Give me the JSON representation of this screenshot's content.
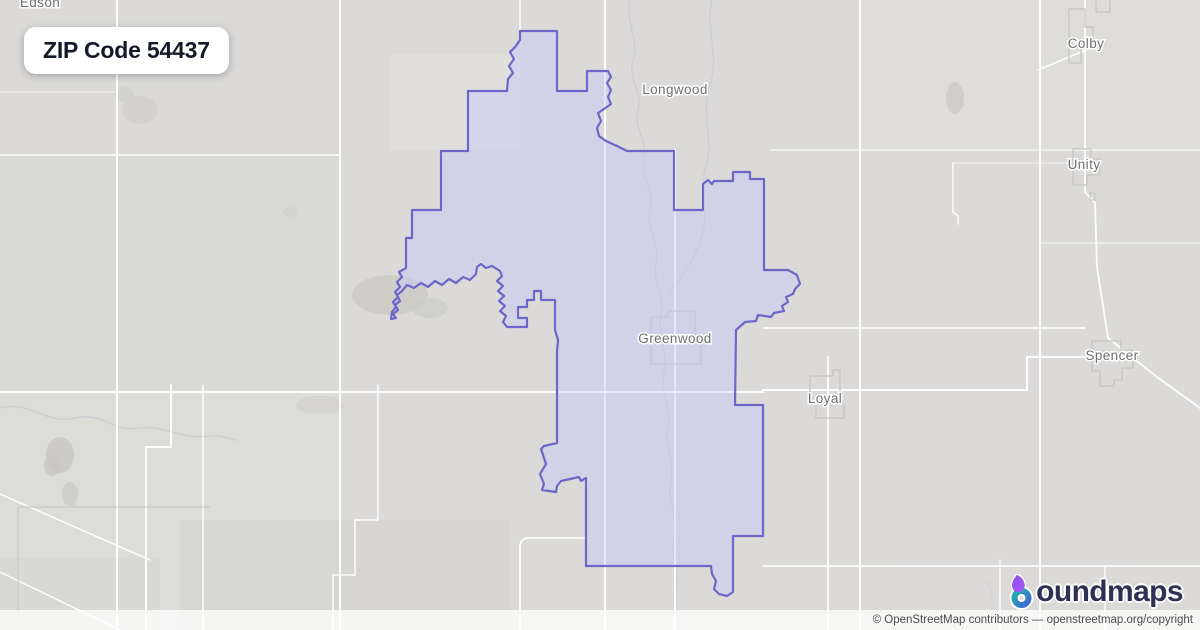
{
  "title_badge": {
    "text": "ZIP Code 54437"
  },
  "map": {
    "zip_code": "54437",
    "background_color": "#dbdad8",
    "zip_fill_color": "rgba(195,200,255,0.42)",
    "zip_stroke_color": "#6f66c9",
    "road_color": "#ffffff",
    "admin_line_color": "#c6c5c2",
    "river_color": "#cbcbd2",
    "label_color": "#6e6e6e",
    "places": [
      {
        "name": "Edson",
        "x": 40,
        "y": 7
      },
      {
        "name": "Longwood",
        "x": 675,
        "y": 94
      },
      {
        "name": "Colby",
        "x": 1086,
        "y": 48
      },
      {
        "name": "Unity",
        "x": 1084,
        "y": 169
      },
      {
        "name": "Greenwood",
        "x": 675,
        "y": 343
      },
      {
        "name": "Loyal",
        "x": 825,
        "y": 403
      },
      {
        "name": "Spencer",
        "x": 1112,
        "y": 360
      }
    ]
  },
  "branding": {
    "name": "boundmaps",
    "wordmark_suffix": "oundmaps",
    "icon_purple": "#8a4bf0",
    "icon_teal": "#1fb3a8",
    "icon_blue": "#3e66d6",
    "navy": "#2e3154"
  },
  "attribution": {
    "text": "© OpenStreetMap contributors — openstreetmap.org/copyright"
  }
}
